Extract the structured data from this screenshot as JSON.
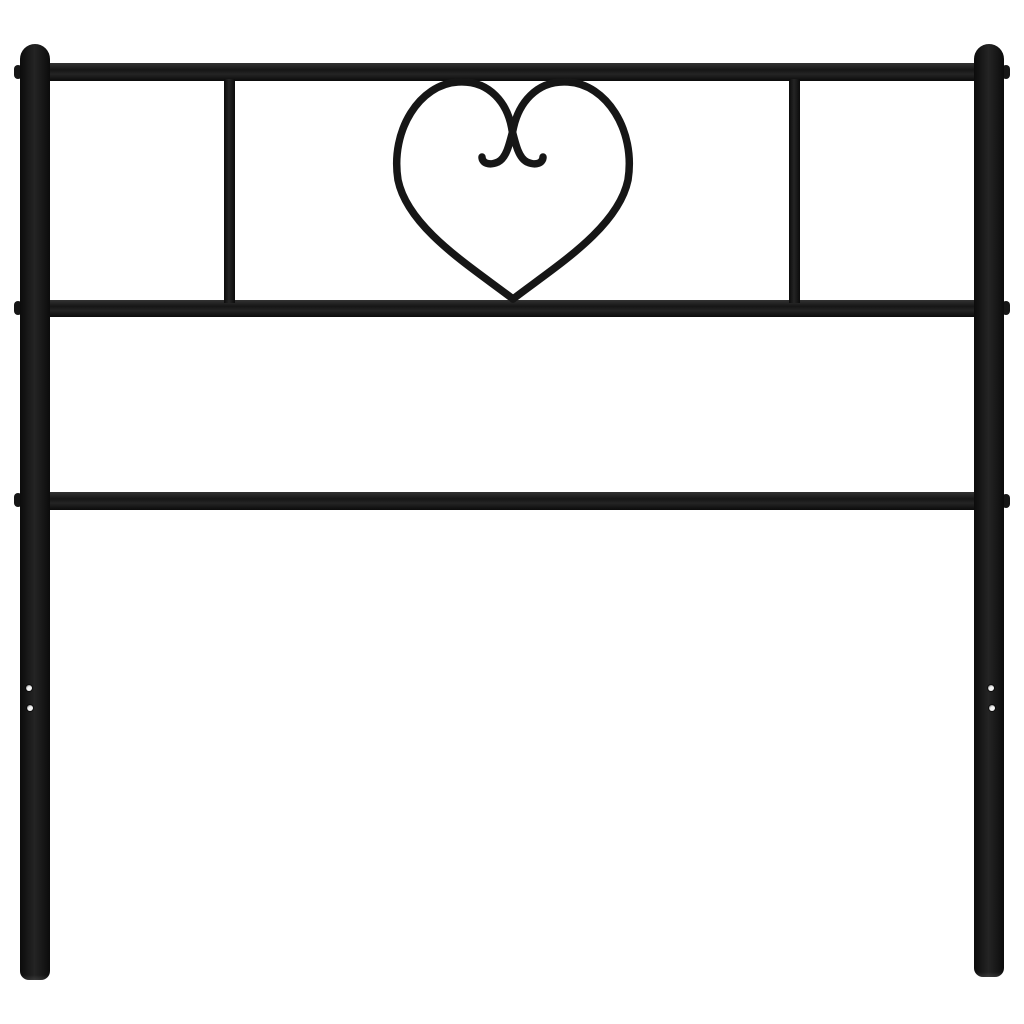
{
  "meta": {
    "type": "product-photo",
    "description": "Black metal bed headboard with two round posts, three horizontal rails, two vertical divider bars and a decorative wrought-iron heart ornament with inner scroll curls, isolated on a plain white background"
  },
  "colors": {
    "background": "#ffffff",
    "metal_black": "#161616",
    "metal_mid": "#242424",
    "metal_edge": "#0b0b0b",
    "metal_highlight": "#323232",
    "hole_bright": "#f5f5f5",
    "hole_ring": "#3c3c3c"
  },
  "headboard": {
    "finish": "matte black metal",
    "posts": 2,
    "horizontal_rails": 3,
    "vertical_divider_bars": 2,
    "ornament": "heart with double scroll curls",
    "bolt_nubs_per_post": 3,
    "screw_holes_per_leg": 2
  }
}
